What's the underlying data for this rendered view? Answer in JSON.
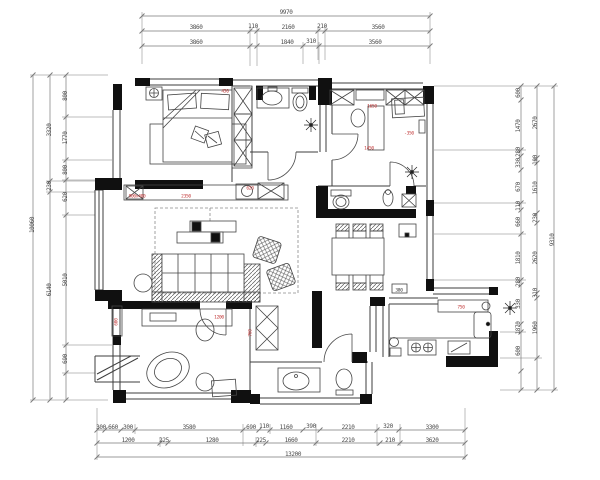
{
  "meta": {
    "drawing_type": "residential floor plan",
    "units": "mm"
  },
  "palette": {
    "line": "#3c3c3c",
    "wall": "#101010",
    "dim_text": "#4a4a4a",
    "annotation": "#c03434",
    "background": "#ffffff"
  },
  "dims": {
    "top": {
      "rows": [
        [
          "9970"
        ],
        [
          "3860",
          "110",
          "2160",
          "210",
          "3560"
        ],
        [
          "3860",
          "1840",
          "310",
          "3560"
        ]
      ]
    },
    "bottom": {
      "rows": [
        [
          "300",
          "660",
          "300",
          "3580",
          "690",
          "110",
          "1160",
          "390",
          "2210",
          "320",
          "3300"
        ],
        [
          "1200",
          "225",
          "1280",
          "225",
          "1660",
          "2210",
          "210",
          "3620"
        ],
        [
          "13200"
        ]
      ]
    },
    "left": {
      "cols": [
        [
          "10060"
        ],
        [
          "3320",
          "230",
          "6140"
        ],
        [
          "800",
          "1770",
          "800",
          "620",
          "5010",
          "690"
        ]
      ]
    },
    "right": {
      "cols": [
        [
          "600",
          "1470",
          "280",
          "330",
          "670",
          "110",
          "660",
          "1810",
          "280",
          "330",
          "1870",
          "600"
        ],
        [
          "2670",
          "100",
          "1610",
          "230",
          "2620",
          "310",
          "1960"
        ],
        [
          "9310"
        ]
      ]
    }
  },
  "annotations": [
    {
      "text": "450",
      "x": 225,
      "y": 92
    },
    {
      "text": "1650",
      "x": 372,
      "y": 107
    },
    {
      "text": "-350",
      "x": 409,
      "y": 134
    },
    {
      "text": "1450",
      "x": 369,
      "y": 149
    },
    {
      "text": "900x400",
      "x": 137,
      "y": 197
    },
    {
      "text": "2350",
      "x": 186,
      "y": 197
    },
    {
      "text": "620",
      "x": 250,
      "y": 189
    },
    {
      "text": "1200",
      "x": 219,
      "y": 318
    },
    {
      "text": "600",
      "x": 117,
      "y": 322,
      "vertical": true
    },
    {
      "text": "760",
      "x": 251,
      "y": 333,
      "vertical": true
    },
    {
      "text": "750",
      "x": 461,
      "y": 308
    },
    {
      "text": "380",
      "x": 399,
      "y": 291,
      "color": "#333333"
    }
  ]
}
